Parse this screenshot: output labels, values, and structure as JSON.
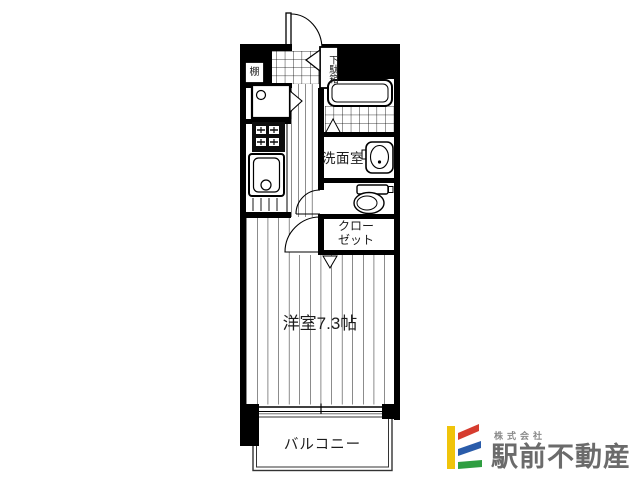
{
  "floor_plan": {
    "ink_color": "#000000",
    "labels": {
      "shelf": "棚",
      "shoe_box": "下駄箱",
      "washroom": "洗面室",
      "closet_line1": "クロー",
      "closet_line2": "ゼット",
      "main_room": "洋室7.3帖",
      "balcony": "バルコニー"
    },
    "icons": {
      "entrance_door": "quarter-circle-door-swing",
      "room_door": "quarter-circle-door-swing",
      "toilet_door": "quarter-circle-door-swing",
      "washing_machine": "square-with-drain-circle",
      "stove": "black-cooktop-square",
      "kitchen_sink": "rounded-sink-with-drain",
      "bathtub": "rounded-rect-tub",
      "wash_basin": "oval-basin",
      "toilet": "tank-and-bowl"
    }
  },
  "logo": {
    "company_prefix": "株式会社",
    "company_name": "駅前不動産",
    "colors": {
      "yellow": "#f0c40a",
      "red": "#d63c2f",
      "blue": "#2a5caa",
      "green": "#2f9e41",
      "text_dark": "#6b6b6b",
      "text_light": "#8a8a8a"
    }
  }
}
